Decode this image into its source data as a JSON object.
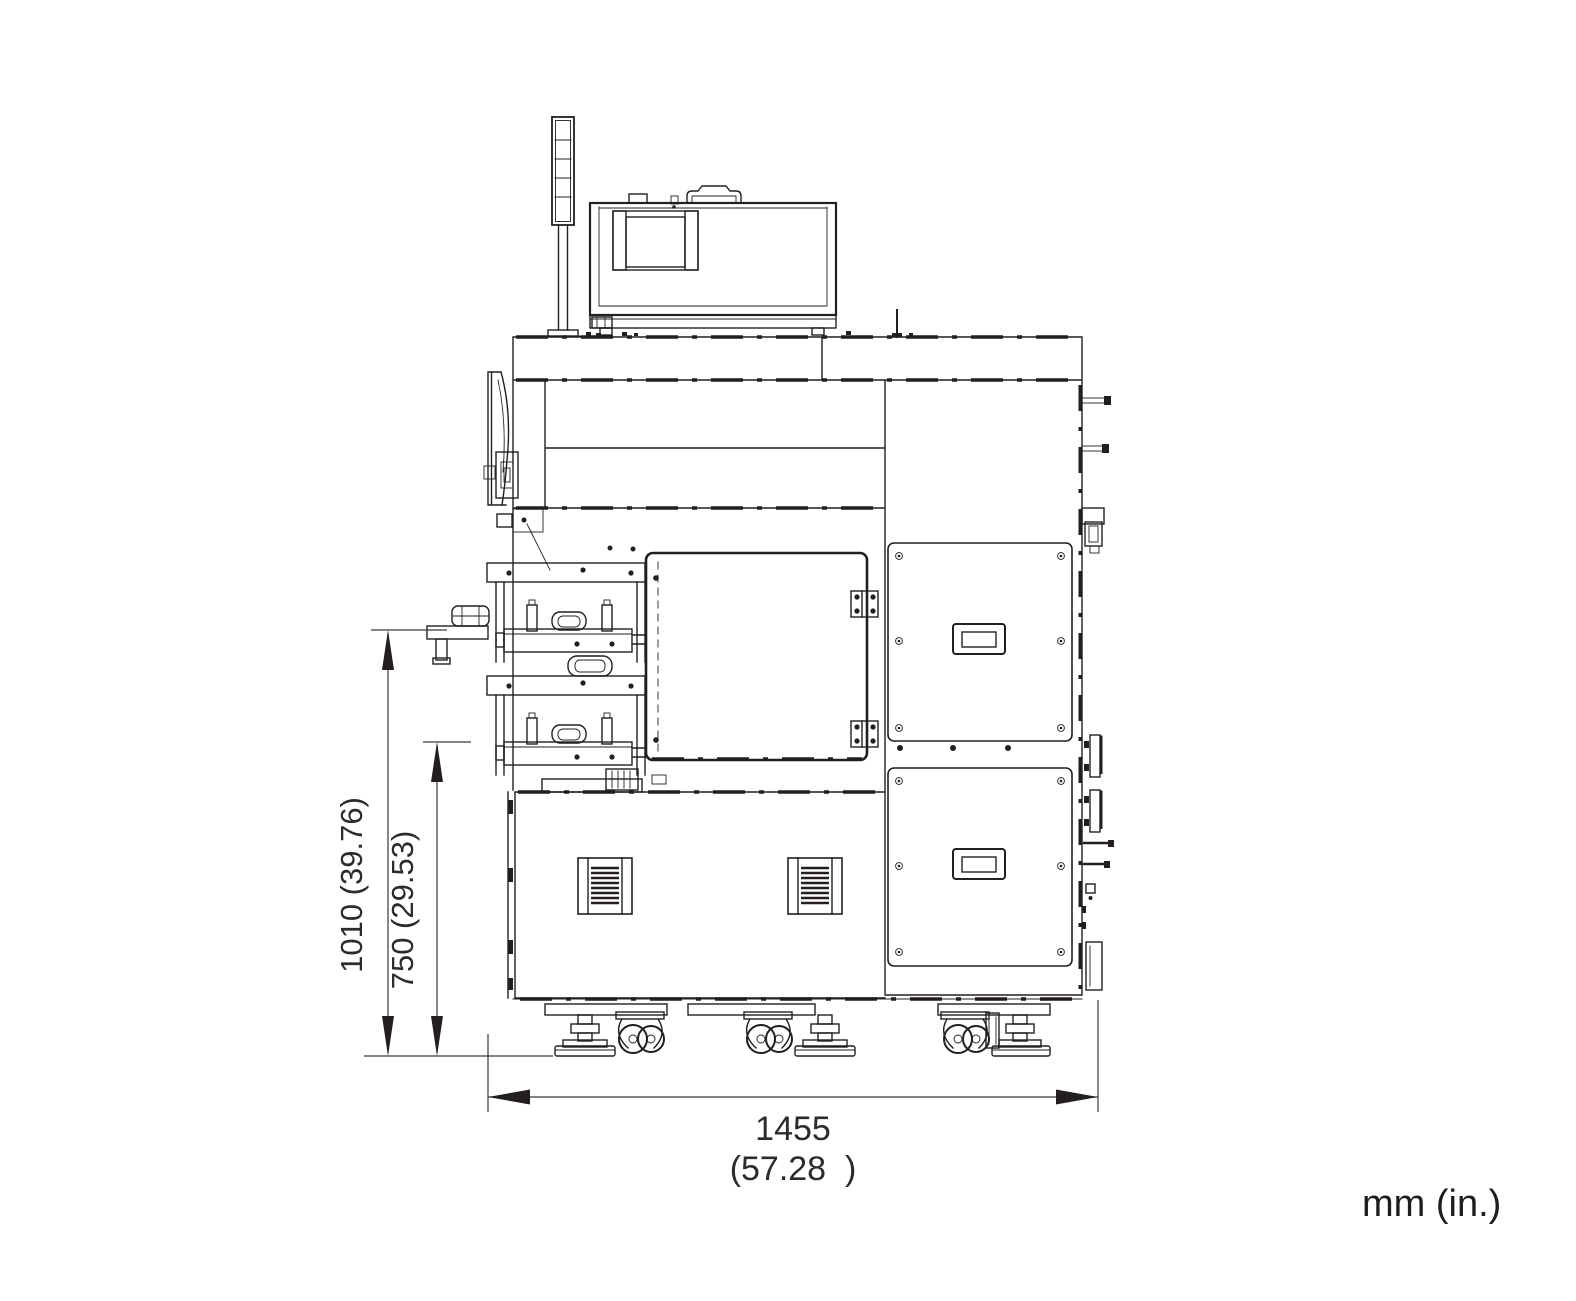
{
  "page": {
    "background": "#ffffff",
    "ink": "#231f20",
    "dimension_text_color": "#2b2b2b"
  },
  "drawing": {
    "kind": "machine front-view dimensional drawing",
    "units_label": "mm (in.)",
    "dimensions": {
      "height_total": {
        "label": "1010 (39.76)",
        "mm": 1010,
        "in": 39.76,
        "orientation": "vertical"
      },
      "height_table": {
        "label": "750 (29.53)",
        "mm": 750,
        "in": 29.53,
        "orientation": "vertical"
      },
      "width_overall": {
        "label_mm": "1455",
        "label_in": "(57.28  )",
        "mm": 1455,
        "in": 57.28,
        "orientation": "horizontal"
      }
    },
    "components": [
      "signal-tower",
      "monitor-enclosure",
      "carry-handle",
      "upper-hood-bands",
      "front-cover-arc",
      "side-table",
      "stacker-tray-upper",
      "stacker-tray-lower",
      "access-door",
      "door-hinges",
      "lower-cabinet",
      "ventilation-grilles",
      "service-panel-upper",
      "service-panel-lower",
      "panel-handles",
      "right-side-fittings",
      "leveling-feet",
      "casters"
    ]
  }
}
